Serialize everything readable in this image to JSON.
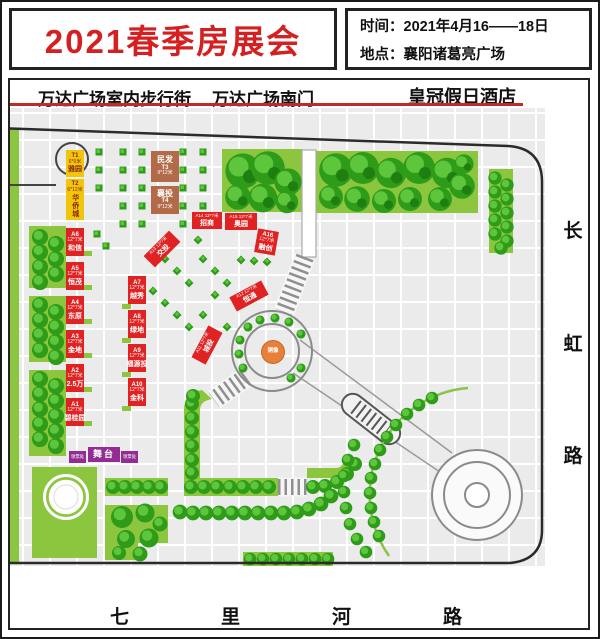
{
  "header": {
    "title": "2021春季房展会",
    "time_label": "时间：2021年4月16——18日",
    "location_label": "地点：襄阳诸葛亮广场"
  },
  "landmarks": {
    "top": [
      "万达广场室内步行街",
      "万达广场南门",
      "皇冠假日酒店"
    ],
    "right_road": "长虹路",
    "bottom_road": "七里河路"
  },
  "colors": {
    "title_red": "#d42020",
    "booth_red": "#e02222",
    "booth_yellow": "#f2c50d",
    "booth_brown": "#b26a48",
    "booth_purple": "#942d93",
    "statue_orange": "#e8803a",
    "tree_green": "#2e9c18",
    "lawn_green": "#8cc63f"
  },
  "map": {
    "booths": [
      {
        "type": "yellow",
        "id": "T1",
        "x": 66,
        "y": 150,
        "w": 18,
        "h": 27,
        "lines": [
          [
            "id",
            "T1"
          ],
          [
            "size",
            "6*6米"
          ],
          [
            "name",
            "雅园"
          ]
        ]
      },
      {
        "type": "yellow",
        "id": "T2",
        "x": 66,
        "y": 179,
        "w": 18,
        "h": 41,
        "lines": [
          [
            "id",
            "T2"
          ],
          [
            "size",
            "6*12米"
          ],
          [
            "name-v",
            "华侨城"
          ]
        ]
      },
      {
        "type": "brown",
        "id": "T3",
        "x": 151,
        "y": 151,
        "w": 28,
        "h": 31,
        "lines": [
          [
            "name-lg",
            "民发"
          ],
          [
            "id",
            "T3"
          ],
          [
            "size",
            "9*12米"
          ]
        ]
      },
      {
        "type": "brown",
        "id": "T4",
        "x": 151,
        "y": 186,
        "w": 28,
        "h": 28,
        "lines": [
          [
            "name-lg",
            "襄投"
          ],
          [
            "id",
            "T4"
          ],
          [
            "size",
            "9*12米"
          ]
        ]
      },
      {
        "type": "red",
        "id": "A6",
        "x": 66,
        "y": 228,
        "w": 18,
        "h": 28,
        "lines": [
          [
            "id",
            "A6"
          ],
          [
            "size",
            "12*7米"
          ],
          [
            "name",
            "和信"
          ]
        ]
      },
      {
        "type": "red",
        "id": "A5",
        "x": 66,
        "y": 262,
        "w": 18,
        "h": 28,
        "lines": [
          [
            "id",
            "A5"
          ],
          [
            "size",
            "12*7米"
          ],
          [
            "name",
            "恒茂"
          ]
        ]
      },
      {
        "type": "red",
        "id": "A4",
        "x": 66,
        "y": 296,
        "w": 18,
        "h": 28,
        "lines": [
          [
            "id",
            "A4"
          ],
          [
            "size",
            "12*7米"
          ],
          [
            "name",
            "东原"
          ]
        ]
      },
      {
        "type": "red",
        "id": "A3",
        "x": 66,
        "y": 330,
        "w": 18,
        "h": 28,
        "lines": [
          [
            "id",
            "A3"
          ],
          [
            "size",
            "12*7米"
          ],
          [
            "name",
            "金地"
          ]
        ]
      },
      {
        "type": "red",
        "id": "A2",
        "x": 66,
        "y": 364,
        "w": 18,
        "h": 28,
        "lines": [
          [
            "id",
            "A2"
          ],
          [
            "size",
            "12*7米"
          ],
          [
            "name",
            "2.5万"
          ]
        ]
      },
      {
        "type": "red",
        "id": "A1",
        "x": 66,
        "y": 398,
        "w": 18,
        "h": 28,
        "lines": [
          [
            "id",
            "A1"
          ],
          [
            "size",
            "12*7米"
          ],
          [
            "name",
            "碧桂园"
          ]
        ]
      },
      {
        "type": "red",
        "id": "A7",
        "x": 128,
        "y": 276,
        "w": 18,
        "h": 28,
        "lines": [
          [
            "id",
            "A7"
          ],
          [
            "size",
            "12*7米"
          ],
          [
            "name",
            "越秀"
          ]
        ]
      },
      {
        "type": "red",
        "id": "A8",
        "x": 128,
        "y": 310,
        "w": 18,
        "h": 28,
        "lines": [
          [
            "id",
            "A8"
          ],
          [
            "size",
            "12*7米"
          ],
          [
            "name",
            "绿地"
          ]
        ]
      },
      {
        "type": "red",
        "id": "A9",
        "x": 128,
        "y": 344,
        "w": 18,
        "h": 28,
        "lines": [
          [
            "id",
            "A9"
          ],
          [
            "size",
            "12*7米"
          ],
          [
            "name",
            "福源投"
          ]
        ]
      },
      {
        "type": "red",
        "id": "A10",
        "x": 128,
        "y": 378,
        "w": 18,
        "h": 28,
        "lines": [
          [
            "id",
            "A10"
          ],
          [
            "size",
            "12*7米"
          ],
          [
            "name",
            "金科"
          ]
        ]
      },
      {
        "type": "red-h",
        "id": "A14",
        "x": 192,
        "y": 212,
        "w": 30,
        "h": 17,
        "lines": [
          [
            "sz",
            "A14 12*7米"
          ],
          [
            "name",
            "招商"
          ]
        ]
      },
      {
        "type": "red-h",
        "id": "A15",
        "x": 225,
        "y": 213,
        "w": 32,
        "h": 17,
        "lines": [
          [
            "sz",
            "A15 12*7米"
          ],
          [
            "name",
            "奥园"
          ]
        ]
      },
      {
        "type": "red",
        "id": "A16",
        "x": 256,
        "y": 230,
        "w": 21,
        "h": 24,
        "rot": 10,
        "lines": [
          [
            "id",
            "A16"
          ],
          [
            "size",
            "12*7米"
          ],
          [
            "name",
            "融创"
          ]
        ]
      },
      {
        "type": "red-h",
        "id": "A13",
        "x": 144,
        "y": 241,
        "w": 36,
        "h": 16,
        "rot": -45,
        "lines": [
          [
            "sz",
            "A13 12*7米"
          ],
          [
            "name",
            "交投"
          ]
        ]
      },
      {
        "type": "red-h",
        "id": "A12",
        "x": 231,
        "y": 288,
        "w": 36,
        "h": 16,
        "rot": -28,
        "lines": [
          [
            "sz",
            "A12 12*7米"
          ],
          [
            "name",
            "恒通"
          ]
        ]
      },
      {
        "type": "red-h",
        "id": "A11",
        "x": 189,
        "y": 337,
        "w": 36,
        "h": 16,
        "rot": -62,
        "lines": [
          [
            "sz",
            "A11 12*7米"
          ],
          [
            "name",
            "城投"
          ]
        ]
      },
      {
        "type": "stage",
        "id": "stage",
        "x": 88,
        "y": 447,
        "w": 32,
        "h": 15,
        "lines": [
          [
            "stage",
            "舞台"
          ]
        ]
      },
      {
        "type": "ticket",
        "id": "ticket-left",
        "x": 69,
        "y": 451,
        "w": 17,
        "h": 12,
        "lines": [
          [
            "tk",
            "领票处"
          ]
        ]
      },
      {
        "type": "ticket",
        "id": "ticket-right",
        "x": 121,
        "y": 451,
        "w": 17,
        "h": 12,
        "lines": [
          [
            "tk",
            "领票处"
          ]
        ]
      },
      {
        "type": "statue",
        "id": "statue",
        "x": 261,
        "y": 340,
        "w": 22,
        "h": 22,
        "lines": [
          [
            "st",
            "铜像"
          ]
        ]
      }
    ]
  }
}
